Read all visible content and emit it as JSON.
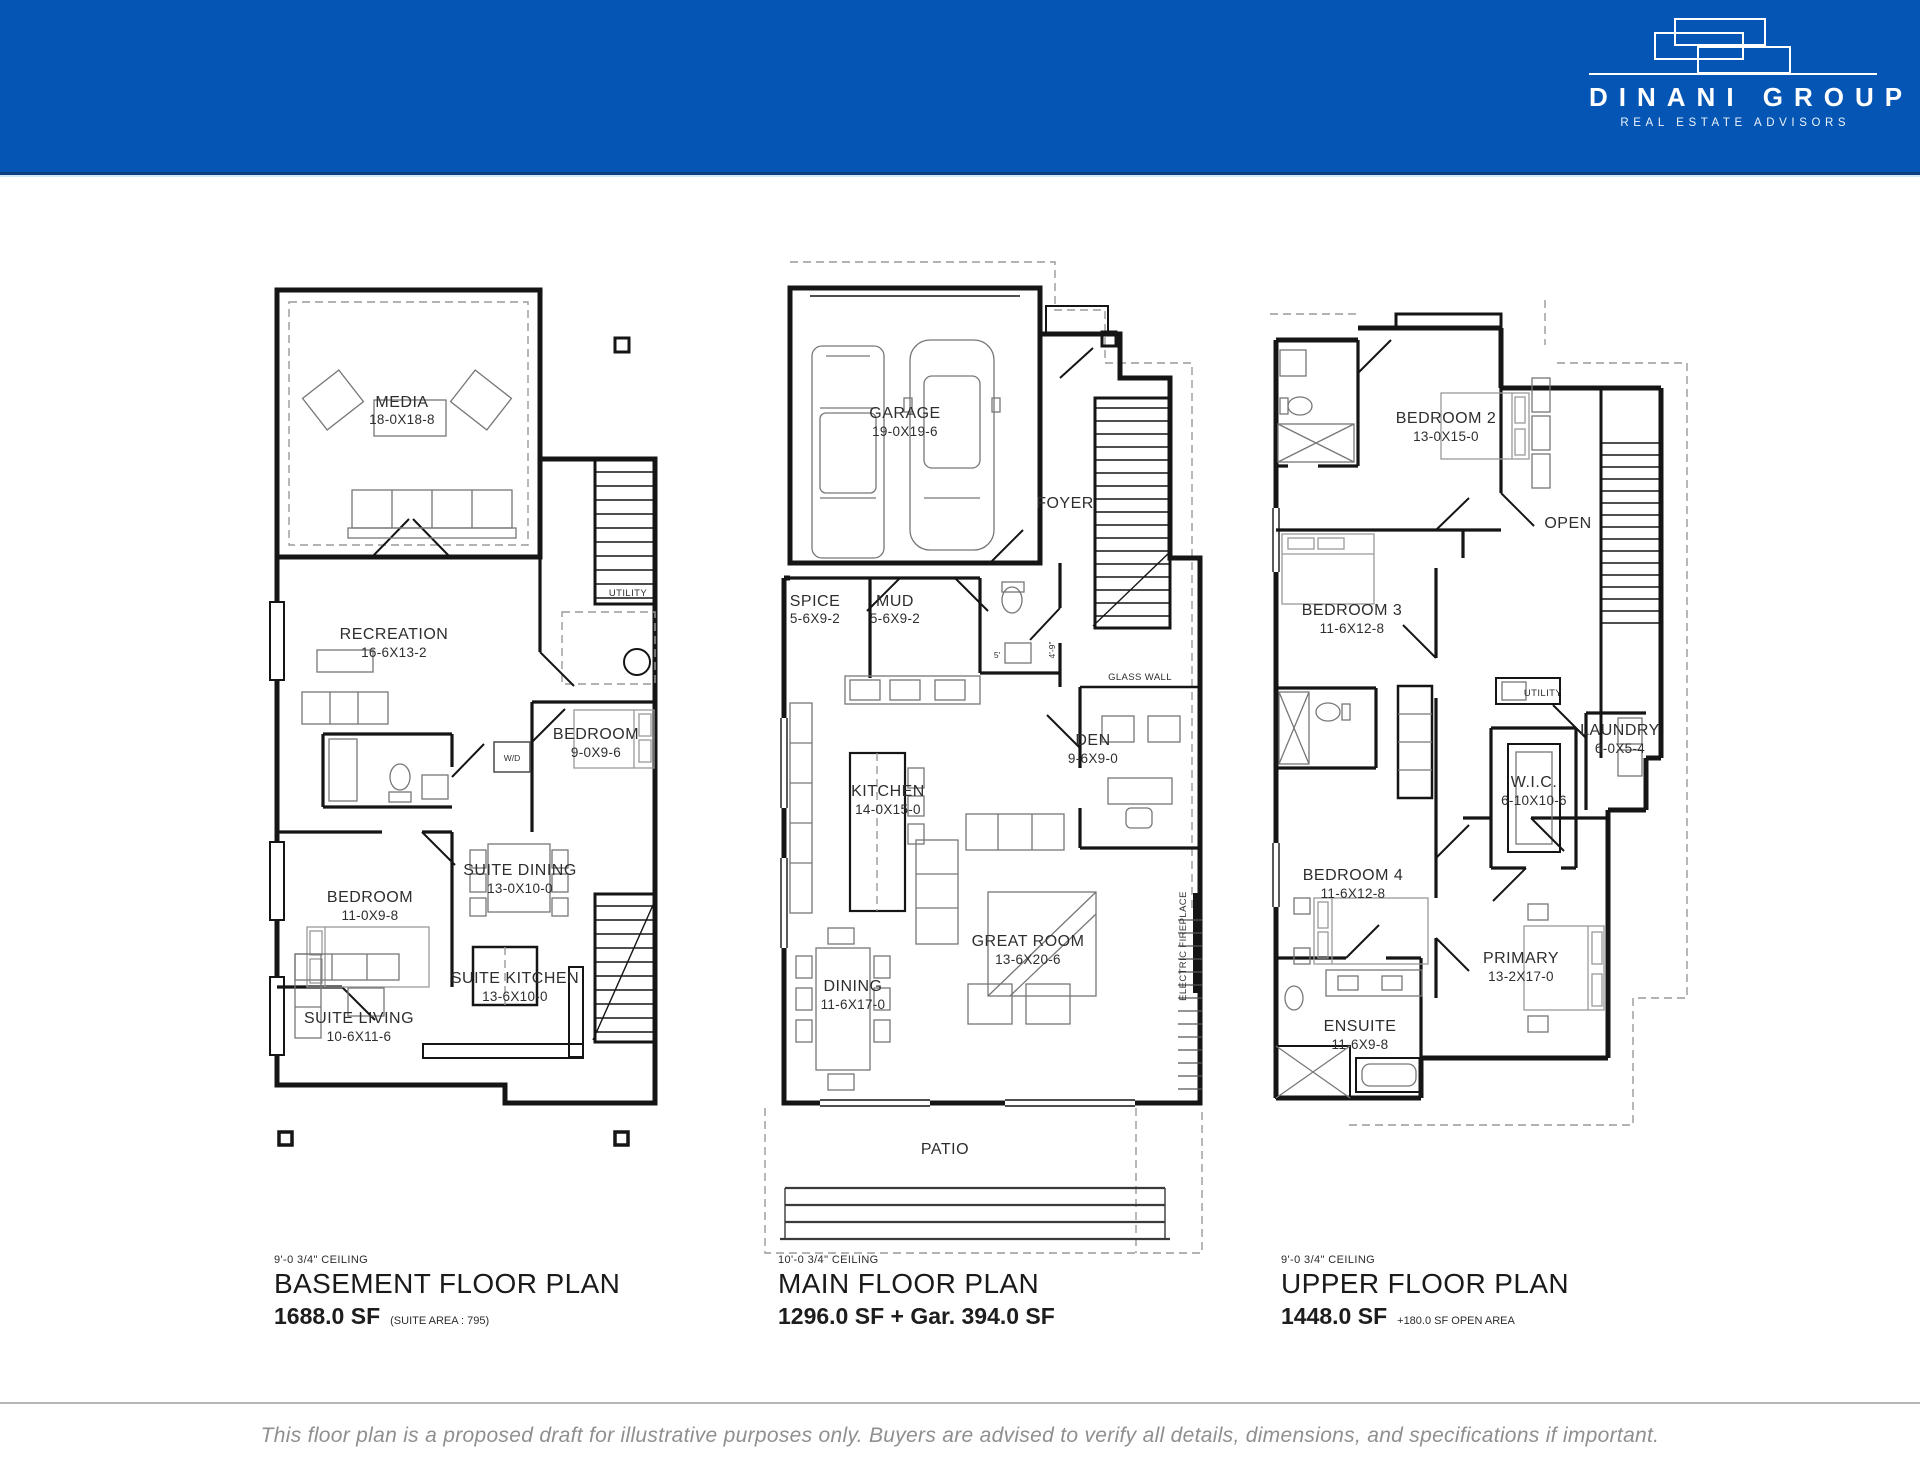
{
  "colors": {
    "header_bar": "#0556b4",
    "drawing_ink": "#151515",
    "disclaimer_text": "#8f8f8f",
    "divider_gray": "#b6b6b6"
  },
  "header": {
    "brand_name": "DINANI GROUP",
    "brand_tagline": "REAL ESTATE ADVISORS",
    "logo_icon": "overlapping-rectangles-logo"
  },
  "plans": {
    "basement": {
      "ceiling": "9'-0 3/4\" CEILING",
      "title": "BASEMENT FLOOR PLAN",
      "area": "1688.0 SF",
      "area_note": "(SUITE AREA : 795)",
      "rooms": {
        "media": {
          "name": "MEDIA",
          "dims": "18-0X18-8"
        },
        "recreation": {
          "name": "RECREATION",
          "dims": "16-6X13-2"
        },
        "utility": {
          "name": "UTILITY",
          "dims": ""
        },
        "bedroom_a": {
          "name": "BEDROOM",
          "dims": "9-0X9-6"
        },
        "wd": {
          "name": "W/D",
          "dims": ""
        },
        "bedroom_b": {
          "name": "BEDROOM",
          "dims": "11-0X9-8"
        },
        "suite_dining": {
          "name": "SUITE DINING",
          "dims": "13-0X10-0"
        },
        "suite_kitchen": {
          "name": "SUITE KITCHEN",
          "dims": "13-6X10-0"
        },
        "suite_living": {
          "name": "SUITE LIVING",
          "dims": "10-6X11-6"
        }
      }
    },
    "main": {
      "ceiling": "10'-0 3/4\" CEILING",
      "title": "MAIN FLOOR PLAN",
      "area": "1296.0 SF + Gar. 394.0 SF",
      "area_note": "",
      "rooms": {
        "garage": {
          "name": "GARAGE",
          "dims": "19-0X19-6"
        },
        "foyer": {
          "name": "FOYER",
          "dims": ""
        },
        "spice": {
          "name": "SPICE",
          "dims": "5-6X9-2"
        },
        "mud": {
          "name": "MUD",
          "dims": "5-6X9-2"
        },
        "glass_wall": {
          "name": "GLASS WALL",
          "dims": ""
        },
        "den": {
          "name": "DEN",
          "dims": "9-6X9-0"
        },
        "kitchen": {
          "name": "KITCHEN",
          "dims": "14-0X15-0"
        },
        "great_room": {
          "name": "GREAT ROOM",
          "dims": "13-6X20-6"
        },
        "dining": {
          "name": "DINING",
          "dims": "11-6X17-0"
        },
        "fireplace": {
          "name": "ELECTRIC FIREPLACE",
          "dims": ""
        },
        "patio": {
          "name": "PATIO",
          "dims": ""
        }
      },
      "annotations": {
        "dim_a": "4'-9\"",
        "dim_b": "5'"
      }
    },
    "upper": {
      "ceiling": "9'-0 3/4\" CEILING",
      "title": "UPPER FLOOR PLAN",
      "area": "1448.0 SF",
      "area_note": "+180.0 SF OPEN AREA",
      "rooms": {
        "bedroom2": {
          "name": "BEDROOM 2",
          "dims": "13-0X15-0"
        },
        "open": {
          "name": "OPEN",
          "dims": ""
        },
        "bedroom3": {
          "name": "BEDROOM 3",
          "dims": "11-6X12-8"
        },
        "utility": {
          "name": "UTILITY",
          "dims": ""
        },
        "laundry": {
          "name": "LAUNDRY",
          "dims": "6-0X5-4"
        },
        "wic": {
          "name": "W.I.C.",
          "dims": "6-10X10-6"
        },
        "bedroom4": {
          "name": "BEDROOM 4",
          "dims": "11-6X12-8"
        },
        "ensuite": {
          "name": "ENSUITE",
          "dims": "11-6X9-8"
        },
        "primary": {
          "name": "PRIMARY",
          "dims": "13-2X17-0"
        }
      }
    }
  },
  "footer": {
    "disclaimer": "This floor plan is a proposed draft for illustrative purposes only. Buyers are advised to verify all details, dimensions, and specifications if important."
  }
}
